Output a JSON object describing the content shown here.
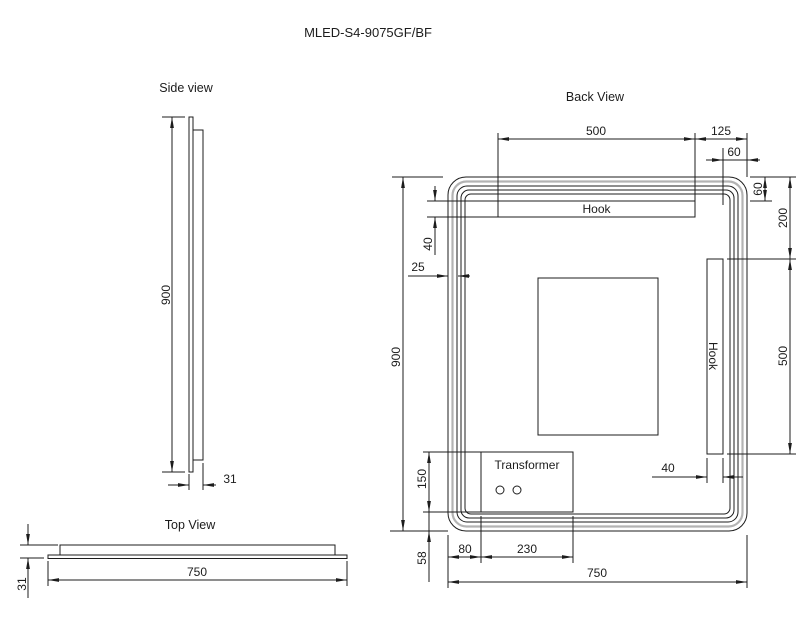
{
  "title": "MLED-S4-9075GF/BF",
  "side_view": {
    "label": "Side view",
    "dim_height": "900",
    "dim_thickness": "31"
  },
  "top_view": {
    "label": "Top View",
    "dim_width": "750",
    "dim_thickness": "31"
  },
  "back_view": {
    "label": "Back View",
    "top_hook_label": "Hook",
    "side_hook_label": "Hook",
    "transformer_label": "Transformer",
    "dim_top_hook_width": "500",
    "dim_top_hook_to_edge": "125",
    "dim_side_hook_to_edge": "60",
    "dim_top_edge_to_hook": "60",
    "dim_top_to_side_hook": "200",
    "dim_side_hook_length": "500",
    "dim_top_hook_height": "40",
    "dim_frame_inset": "25",
    "dim_height": "900",
    "dim_transformer_height": "150",
    "dim_bottom_offset": "58",
    "dim_transformer_left_offset": "80",
    "dim_transformer_width": "230",
    "dim_width": "750",
    "dim_side_hook_width": "40"
  },
  "colors": {
    "line": "#1c1c1c",
    "led_strip": "#b3b3b3",
    "background": "#ffffff"
  }
}
